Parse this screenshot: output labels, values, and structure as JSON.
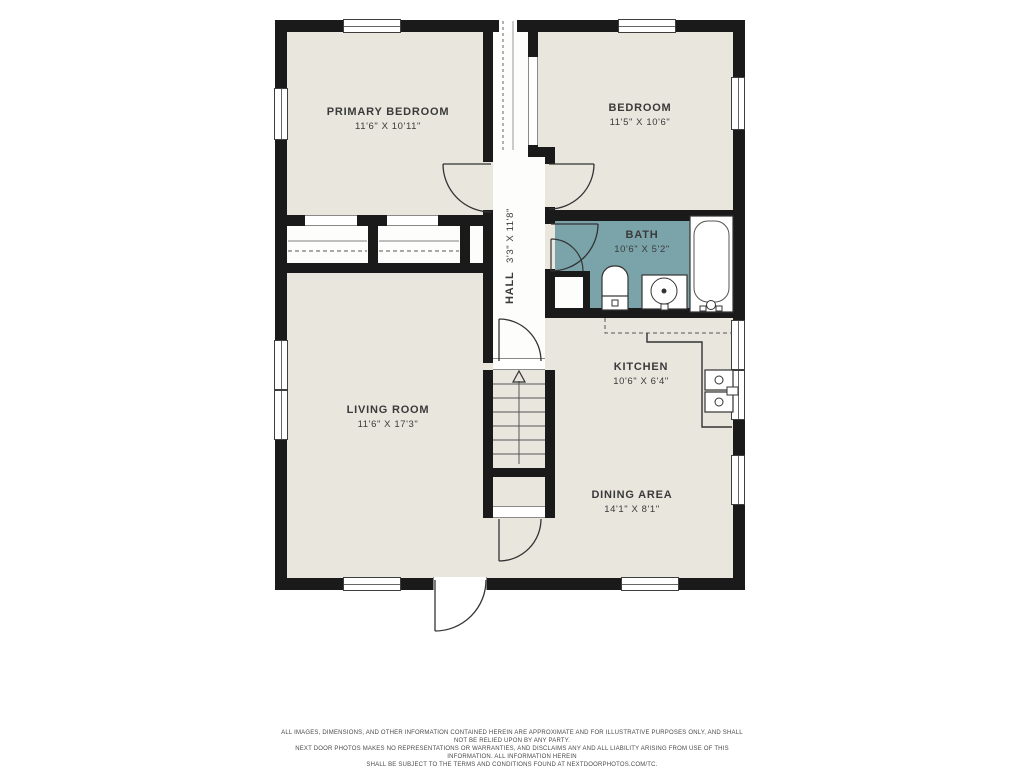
{
  "plan_title": "floor-plan",
  "rooms": [
    {
      "id": "primary-bedroom",
      "name": "PRIMARY BEDROOM",
      "dims": "11'6\" X 10'11\""
    },
    {
      "id": "bedroom",
      "name": "BEDROOM",
      "dims": "11'5\" X 10'6\""
    },
    {
      "id": "bath",
      "name": "BATH",
      "dims": "10'6\" X 5'2\""
    },
    {
      "id": "hall",
      "name": "HALL",
      "dims": "3'3\" X 11'8\""
    },
    {
      "id": "kitchen",
      "name": "KITCHEN",
      "dims": "10'6\" X 6'4\""
    },
    {
      "id": "living-room",
      "name": "LIVING ROOM",
      "dims": "11'6\" X 17'3\""
    },
    {
      "id": "dining-area",
      "name": "DINING AREA",
      "dims": "14'1\" X 8'1\""
    }
  ],
  "disclaimer": {
    "line1": "ALL IMAGES, DIMENSIONS, AND OTHER INFORMATION CONTAINED HEREIN ARE APPROXIMATE AND FOR ILLUSTRATIVE PURPOSES ONLY, AND SHALL NOT BE RELIED UPON BY ANY PARTY.",
    "line2": "NEXT DOOR PHOTOS MAKES NO REPRESENTATIONS OR WARRANTIES, AND DISCLAIMS ANY AND ALL LIABILITY ARISING FROM USE OF THIS INFORMATION. ALL INFORMATION HEREIN",
    "line3": "SHALL BE SUBJECT TO THE TERMS AND CONDITIONS FOUND AT NEXTDOORPHOTOS.COM/TC."
  },
  "colors": {
    "wall": "#1a1a1a",
    "floor": "#e9e6de",
    "hall_floor": "#fdfdfb",
    "bath_floor": "#7ba4aa",
    "background": "#ffffff"
  }
}
